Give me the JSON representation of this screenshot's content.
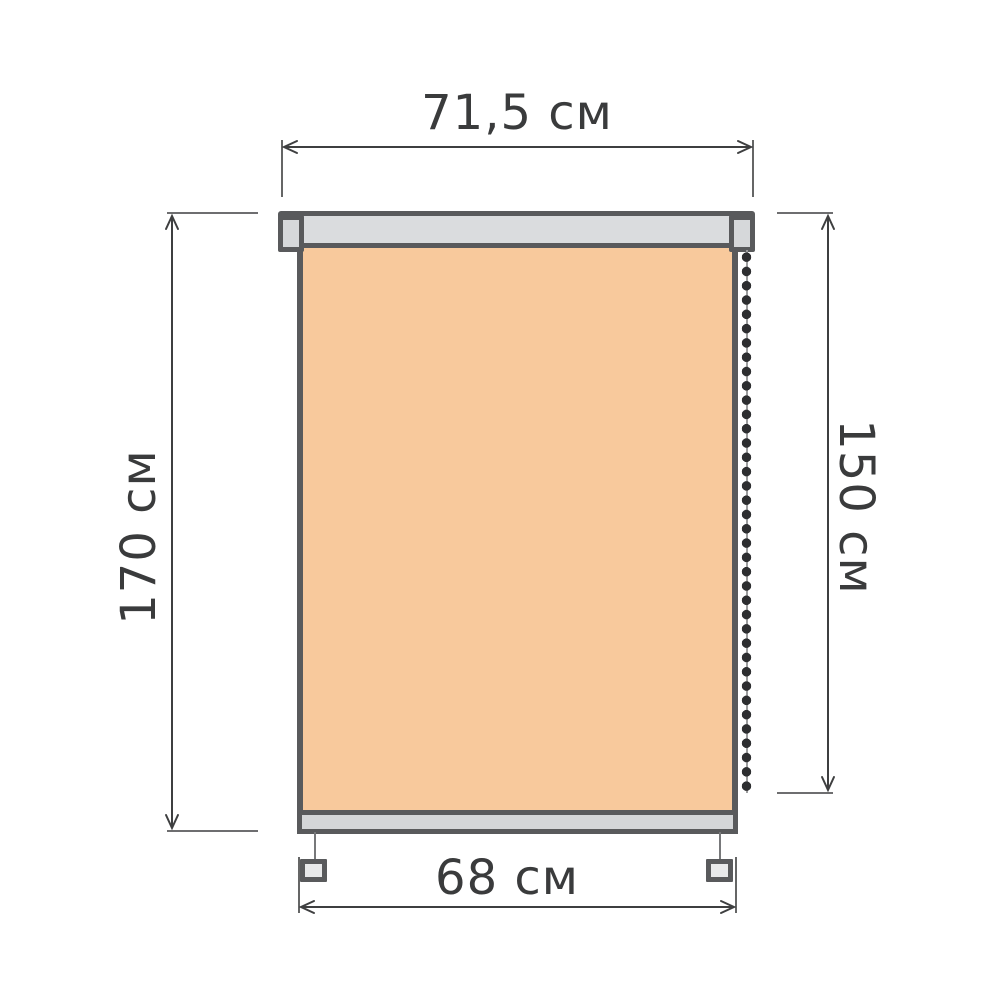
{
  "diagram": {
    "type": "roller-blind-dimension-drawing",
    "labels": {
      "width_top": "71,5 см",
      "height_left": "170 см",
      "height_right": "150 см",
      "width_bottom": "68 см"
    },
    "measurements": {
      "overall_width_cm": 71.5,
      "overall_height_cm": 170,
      "drop_height_cm": 150,
      "fabric_width_cm": 68,
      "unit": "см"
    },
    "colors": {
      "background": "#ffffff",
      "fabric": "#f8c99c",
      "rail_fill": "#dadcde",
      "bar_fill": "#d4d6d8",
      "bracket_fill": "#e8e9ea",
      "outline": "#595a5c",
      "dimension_lines": "#3e3f40",
      "text": "#3a3b3c",
      "chain_bead": "#2d2e30",
      "chain_cord": "#9c9d9e"
    }
  }
}
